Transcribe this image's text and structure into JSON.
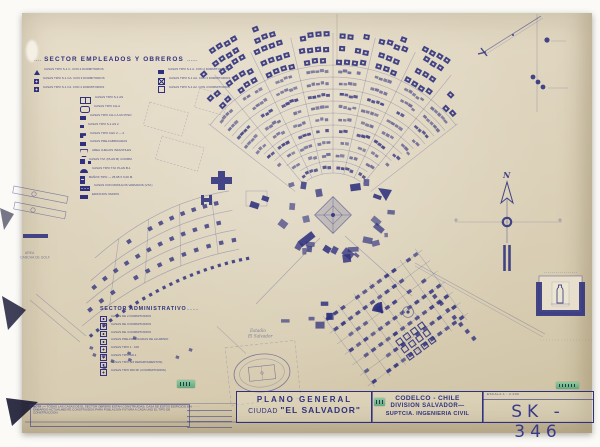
{
  "sheet": {
    "drawing_number": "SK - 346",
    "escala": "ESCALA   1 : 2.000"
  },
  "title_block": {
    "line1": "PLANO GENERAL",
    "city_prefix": "CIUDAD",
    "city_name": "\"EL SALVADOR\"",
    "company": "CODELCO - CHILE",
    "division": "DIVISION  SALVADOR—",
    "department": "SUPTCIA.   INGENIERIA   CIVIL"
  },
  "legend_empleados": {
    "title": "SECTOR  EMPLEADOS  Y  OBREROS",
    "title_dots": "......",
    "grid_left": [
      {
        "icon": "triangle-icon",
        "label": "CASAS TIPO S-1 C.  CON 2 DORMITORIOS"
      },
      {
        "icon": "square-dot-icon",
        "label": "CASAS TIPO S-1 CA.  CON 3 DORMITORIOS"
      },
      {
        "icon": "square-dot-icon",
        "label": "CASAS TIPO S-1 C2.  CON 4 DORMITORIOS"
      }
    ],
    "grid_right": [
      {
        "icon": "solid-square-icon",
        "label": "CASAS TIPO S-1 A.  CON 2 DORMITORIOS"
      },
      {
        "icon": "hatched-square-icon",
        "label": "CASAS TIPO S-1 AA.  CON 3 DORMITORIOS"
      },
      {
        "icon": "outline-square-icon",
        "label": "CASAS TIPO S-1 A2.  CON 4 DORMITORIOS"
      }
    ],
    "rows": [
      {
        "icon": "pair-square-icon",
        "label": "CASAS  TIPO  S-1 AS"
      },
      {
        "icon": "oval-icon",
        "label": "CASAS  TIPO  CH-A"
      },
      {
        "icon": "solid-square-icon",
        "label": "CASAS  TIPO  CH-1 A UN PISO"
      },
      {
        "icon": "small-solid-icon",
        "label": "CASAS  TIPO  S-1 AS  2"
      },
      {
        "icon": "step-block-icon",
        "label": "CASAS  TIPO CHC 2  —  2"
      },
      {
        "icon": "solid-square-icon",
        "label": "CASAS  PRE-FABRICADAS"
      },
      {
        "icon": "trapezoid-icon",
        "label": "AREA JUEGOS INFANTILES"
      },
      {
        "icon": "square-plus-icon",
        "label": "CASAS  T.M. (PLAN B) 4 DORM."
      },
      {
        "icon": "arch-icon",
        "label": "CASAS  TIPO T.M. PLAN B-1"
      },
      {
        "icon": "tall-block-icon",
        "label": "BAÑOS   TIPO — 25,68 X 6,00 M."
      },
      {
        "icon": "dotted-wide-icon",
        "label": "CASAS CON MODULOS VARIADOS (V.M.)"
      },
      {
        "icon": "wide-solid-icon",
        "label": "EDIFICIOS  VARIOS"
      }
    ]
  },
  "legend_administrativo": {
    "title": "SECTOR  ADMINISTRATIVO",
    "rows": [
      {
        "icon": "admin-square-icon",
        "label": "CASAS  DE  2  DORMITORIOS"
      },
      {
        "icon": "admin-square-icon",
        "label": "CASAS  DE  3  DORMITORIOS"
      },
      {
        "icon": "admin-square-icon",
        "label": "CASAS  DE  4  DORMITORIOS"
      },
      {
        "icon": "admin-square-icon",
        "label": "CASAS  PRE-FABRICADAS  DE  ALUMINIO"
      },
      {
        "icon": "admin-square-icon",
        "label": "CASAS  TIPO   1 : 100"
      },
      {
        "icon": "admin-square-icon",
        "label": "CASAS  TIPO   AD-1"
      },
      {
        "icon": "admin-square-icon",
        "label": "CASAS  TIPO   (24  DEPARTAMENTOS)"
      },
      {
        "icon": "admin-square-icon",
        "label": "CASAS  TIPO  300 M²  (4 DORMITORIOS)"
      }
    ]
  },
  "nota": {
    "label": "NOTA :—",
    "lines": [
      "TODAS LAS CASAS DE EL SECTOR OBRERO ESTAN CONSTRUIDAS; CASA DE ESTOS EDIFICIOS  SIN",
      "EMBARGO ACTUALMENTE CONSTRUIDOS PARA POBLACION FUTURA A CADA UNO EL TIPO DE",
      "CONSTRUCCION."
    ]
  },
  "revision_rows": [
    "······  ·  ····",
    "······  ·  ····",
    "······  ·  ····",
    "······  ·  ····"
  ],
  "map_labels": {
    "north": "N",
    "estadio_line1": "Estadio",
    "estadio_line2": "El Salvador",
    "golf_line1": "AREA",
    "golf_line2": "CANCHA DE GOLF"
  },
  "colors": {
    "ink": "#2f317e",
    "paper": "#ddd3bd",
    "sticker_green": "#6fae85"
  }
}
